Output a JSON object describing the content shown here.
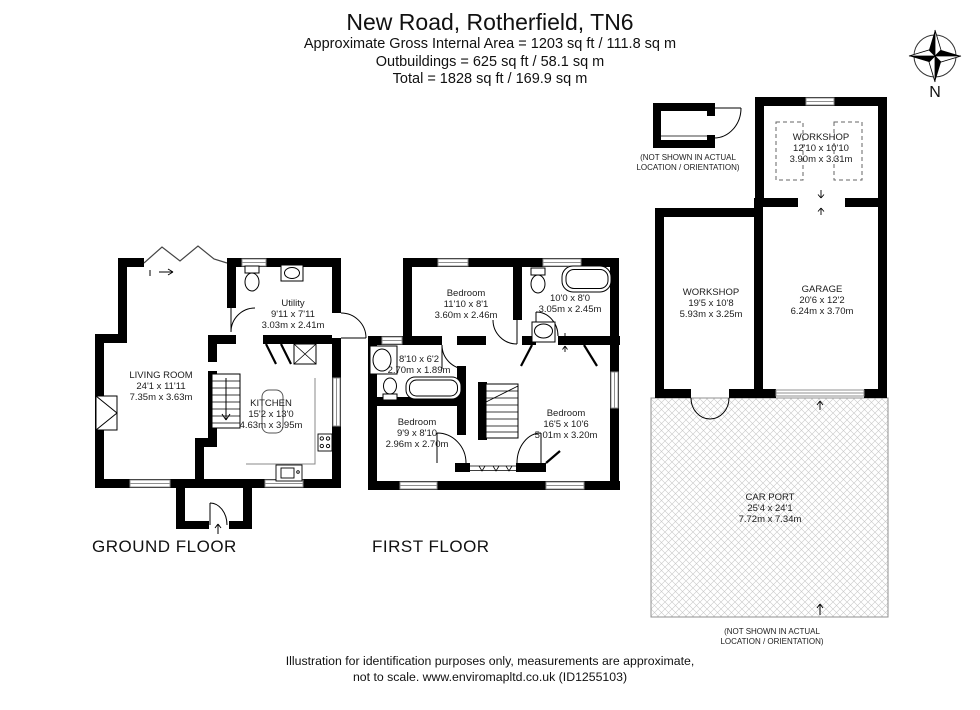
{
  "header": {
    "title": "New Road, Rotherfield, TN6",
    "line1": "Approximate Gross Internal Area = 1203 sq ft / 111.8 sq m",
    "line2": "Outbuildings = 625 sq ft / 58.1 sq m",
    "line3": "Total = 1828 sq ft / 169.9 sq m"
  },
  "compass": {
    "label": "N"
  },
  "floors": {
    "ground": {
      "label": "GROUND FLOOR"
    },
    "first": {
      "label": "FIRST FLOOR"
    }
  },
  "rooms": {
    "living": {
      "name": "LIVING ROOM",
      "imperial": "24'1 x 11'11",
      "metric": "7.35m x 3.63m"
    },
    "utility": {
      "name": "Utility",
      "imperial": "9'11 x 7'11",
      "metric": "3.03m x 2.41m"
    },
    "kitchen": {
      "name": "KITCHEN",
      "imperial": "15'2 x 13'0",
      "metric": "4.63m x 3.95m"
    },
    "bedroom1": {
      "name": "Bedroom",
      "imperial": "11'10 x 8'1",
      "metric": "3.60m x 2.46m"
    },
    "bathroom1": {
      "imperial": "10'0 x 8'0",
      "metric": "3.05m x 2.45m"
    },
    "bathroom2": {
      "imperial": "8'10 x 6'2",
      "metric": "2.70m x 1.89m"
    },
    "bedroom2": {
      "name": "Bedroom",
      "imperial": "9'9 x 8'10",
      "metric": "2.96m x 2.70m"
    },
    "bedroom3": {
      "name": "Bedroom",
      "imperial": "16'5 x 10'6",
      "metric": "5.01m x 3.20m"
    },
    "workshop1": {
      "name": "WORKSHOP",
      "imperial": "12'10 x 10'10",
      "metric": "3.90m x 3.31m"
    },
    "workshop2": {
      "name": "WORKSHOP",
      "imperial": "19'5 x 10'8",
      "metric": "5.93m x 3.25m"
    },
    "garage": {
      "name": "GARAGE",
      "imperial": "20'6 x 12'2",
      "metric": "6.24m x 3.70m"
    },
    "carport": {
      "name": "CAR PORT",
      "imperial": "25'4 x 24'1",
      "metric": "7.72m x 7.34m"
    }
  },
  "notes": {
    "not_shown_line1": "(NOT SHOWN IN ACTUAL",
    "not_shown_line2": "LOCATION / ORIENTATION)"
  },
  "footer": {
    "line1": "Illustration for identification purposes only, measurements are approximate,",
    "line2": "not to scale. www.enviromapltd.co.uk (ID1255103)"
  },
  "colors": {
    "wall": "#000000",
    "window_frame": "#909090",
    "hatch": "#c8c8c8"
  }
}
